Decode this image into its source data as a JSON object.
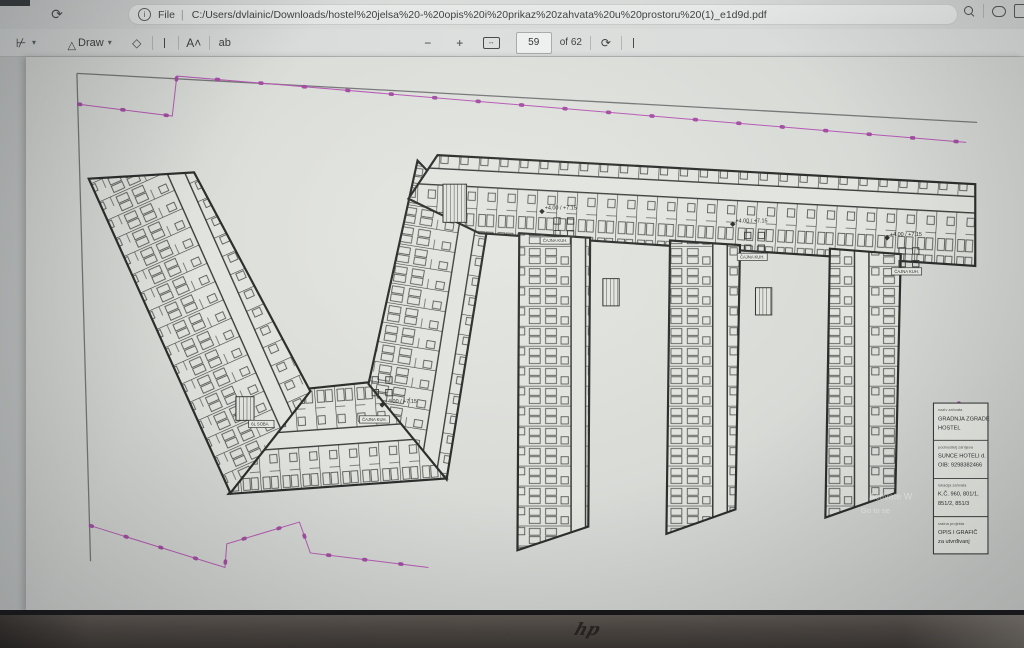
{
  "browser": {
    "reload_glyph": "⟳",
    "info_glyph": "i",
    "file_label": "File",
    "separator": "|",
    "url": "C:/Users/dvlainic/Downloads/hostel%20jelsa%20-%20opis%20i%20prikaz%20zahvata%20u%20prostoru%20(1)_e1d9d.pdf"
  },
  "pdf_toolbar": {
    "highlighter_chevron": "▾",
    "draw_nib_glyph": "▽",
    "draw_label": "Draw",
    "draw_chevron": "▾",
    "read_aloud_label": "A˄",
    "text_label": "ab",
    "zoom_out": "−",
    "zoom_in": "+",
    "fit_glyph": "↔",
    "page_current": "59",
    "page_total_label": "of 62",
    "rotate_glyph": "⟳"
  },
  "plan": {
    "labels": {
      "tea_kitchen": "ČAJNA KUH.",
      "level": "+4.00 / +7.15",
      "room": "6L SOBA"
    },
    "title_block": {
      "rows": [
        {
          "label": "naziv zahvata",
          "line1": "GRADNJA ZGRADE",
          "line2": "HOSTEL"
        },
        {
          "label": "podnositelj zahtjeva",
          "line1": "SUNCE HOTELI d.",
          "line2": "OIB: 9298382466"
        },
        {
          "label": "lokacija zahvata",
          "line1": "K.Č. 960, 801/1,",
          "line2": "851/2, 851/3"
        },
        {
          "label": "razina projekta",
          "line1": "OPIS I GRAFIČ",
          "line2": "za utvrđivanj"
        }
      ]
    },
    "colors": {
      "boundary_magenta": "#b65ab4",
      "line_dark": "#343634"
    }
  },
  "watermark": {
    "line1": "Activate W",
    "line2": "Go to se"
  },
  "device": {
    "logo": "hp"
  }
}
